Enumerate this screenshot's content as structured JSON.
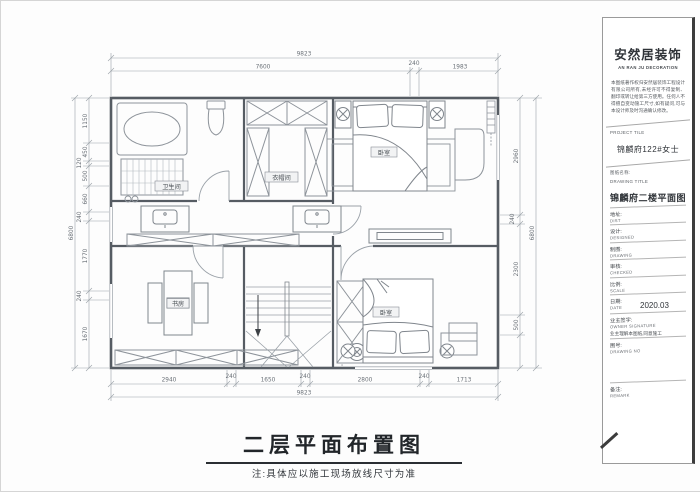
{
  "footer": {
    "title": "二层平面布置图",
    "note": "注:具体应以施工现场放线尺寸为准"
  },
  "title_block": {
    "brand": "安然居装饰",
    "brand_en": "AN RAN JU DECORATION",
    "copyright": "本图纸著作权归安然居装饰工程设计有限公司所有,未经许可不得复制、翻印或转让给第三方使用。任何人不得擅自变动施工尺寸,如有疑问,可与本设计师及时沟通确认修改。",
    "project_label": "PROJECT TILE",
    "project_name": "锦麟府122#女士",
    "drawing_title_cn": "图纸名称:",
    "drawing_title_en": "DRAWING TITLE",
    "drawing_title": "锦麟府二楼平面图",
    "fields": [
      {
        "cn": "地址:",
        "en": "DIST"
      },
      {
        "cn": "设计:",
        "en": "DESIGNED"
      },
      {
        "cn": "制图:",
        "en": "DRAWING"
      },
      {
        "cn": "审核:",
        "en": "CHECKED"
      },
      {
        "cn": "比例:",
        "en": "SCALE"
      },
      {
        "cn": "日期:",
        "en": "DATE"
      }
    ],
    "date_value": "2020.03",
    "owner_cn": "业主签字:",
    "owner_en": "OWNER SIGNATURE",
    "owner_note": "业主理解本图纸,同意施工",
    "drawing_no_cn": "图号:",
    "drawing_no_en": "DRAWING NO",
    "remark_cn": "备注:",
    "remark_en": "REMARK"
  },
  "plan": {
    "room_labels": {
      "bathroom": "卫生间",
      "cloakroom": "衣帽间",
      "bedroom_top": "卧室",
      "study": "书房",
      "bedroom_bottom": "卧室"
    },
    "dims": {
      "top_total": "9823",
      "top_segments": [
        "7600",
        "240",
        "1983"
      ],
      "bottom_segments": [
        "2940",
        "240",
        "1650",
        "240",
        "2800",
        "240",
        "1713"
      ],
      "bottom_total": "9823",
      "left_segments": [
        "1150",
        "450",
        "120",
        "500",
        "660",
        "240",
        "1770",
        "240",
        "1670"
      ],
      "left_total": "6800",
      "right_segments": [
        "2960",
        "240",
        "2300",
        "500"
      ],
      "right_total": "6800"
    }
  }
}
